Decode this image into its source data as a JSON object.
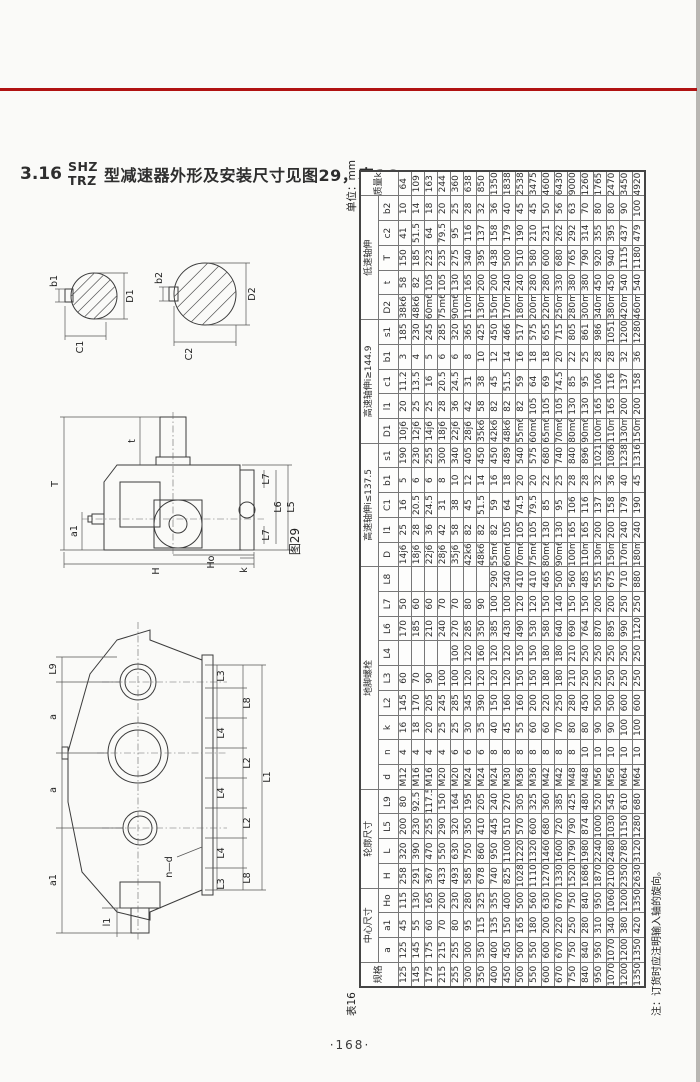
{
  "colors": {
    "rule_red": "#b01212"
  },
  "title": {
    "section": "3.16",
    "model_top": "SHZ",
    "model_bottom": "TRZ",
    "text": "型减速器外形及安装尺寸见图29，表16."
  },
  "page_number": "·168·",
  "figure29": {
    "caption": "图29",
    "shaft_small": {
      "b1": "b1",
      "C1": "C1",
      "D1": "D1"
    },
    "shaft_large": {
      "b2": "b2",
      "C2": "C2",
      "D2": "D2"
    },
    "side_view": {
      "T": "T",
      "t": "t",
      "a1": "a1",
      "H": "H",
      "Ho": "Ho",
      "L5": "L5",
      "L6": "L6",
      "L7_top": "L7",
      "L7_bottom": "L7",
      "k": "k"
    },
    "top_view": {
      "L9": "L9",
      "a_upper": "a",
      "a_lower": "a",
      "a1": "a1",
      "l1": "l1",
      "n_d": "n—d",
      "L1": "L1",
      "L3_top": "L3",
      "L8_top": "L8",
      "L4_top": "L4",
      "L2_upper": "L2",
      "L4_mid": "L4",
      "L2_lower": "L2",
      "L4_bot": "L4",
      "L8_bot": "L8",
      "L3_bot": "L3"
    }
  },
  "table16": {
    "caption": "表16",
    "unit": "单位：mm",
    "note": "注：订货时应注明输入轴的旋向。",
    "col_groups": [
      {
        "label": "规格"
      },
      {
        "label": "中心尺寸",
        "cols": [
          "a",
          "a1",
          "Ho"
        ]
      },
      {
        "label": "轮廓尺寸",
        "cols": [
          "H",
          "L",
          "L5",
          "L9"
        ]
      },
      {
        "label": "地脚螺栓",
        "cols": [
          "d",
          "n",
          "k",
          "L2",
          "L3",
          "L4",
          "L6",
          "L7",
          "L8"
        ]
      },
      {
        "label": "高速轴伸i≤137.5",
        "cols": [
          "D",
          "l1",
          "C1",
          "b1",
          "s1"
        ]
      },
      {
        "label": "高速轴伸i≥144.9",
        "cols": [
          "D1",
          "l1",
          "c1",
          "b1",
          "s1"
        ]
      },
      {
        "label": "低速轴伸",
        "cols": [
          "D2",
          "t",
          "T",
          "c2",
          "b2"
        ]
      },
      {
        "label": "质量kg"
      }
    ],
    "rows": [
      [
        125,
        125,
        45,
        115,
        258,
        320,
        200,
        80,
        "M12",
        4,
        16,
        145,
        60,
        "",
        170,
        50,
        "",
        "14j6",
        25,
        16,
        5,
        190,
        "10j6",
        20,
        11.2,
        3,
        185,
        "38k6",
        58,
        150,
        41,
        10,
        64
      ],
      [
        145,
        145,
        55,
        130,
        291,
        390,
        230,
        92.5,
        "M16",
        4,
        18,
        170,
        70,
        "",
        185,
        60,
        "",
        "18j6",
        28,
        20.5,
        6,
        230,
        "12j6",
        25,
        13.5,
        4,
        230,
        "48k6",
        82,
        185,
        51.5,
        14,
        109
      ],
      [
        175,
        175,
        60,
        165,
        367,
        470,
        255,
        117.5,
        "M16",
        4,
        20,
        205,
        90,
        "",
        210,
        60,
        "",
        "22j6",
        36,
        24.5,
        6,
        255,
        "14j6",
        25,
        16,
        5,
        245,
        "60m6",
        105,
        223,
        64,
        18,
        163
      ],
      [
        215,
        215,
        70,
        200,
        433,
        550,
        290,
        150,
        "M20",
        4,
        25,
        245,
        100,
        "",
        240,
        70,
        "",
        "28j6",
        42,
        31,
        8,
        300,
        "18j6",
        28,
        20.5,
        6,
        285,
        "75m6",
        105,
        235,
        79.5,
        20,
        244
      ],
      [
        255,
        255,
        80,
        230,
        493,
        630,
        320,
        164,
        "M20",
        6,
        25,
        285,
        100,
        100,
        270,
        70,
        "",
        "35j6",
        58,
        38,
        10,
        340,
        "22j6",
        36,
        24.5,
        6,
        320,
        "90m6",
        130,
        275,
        95,
        25,
        360
      ],
      [
        300,
        300,
        95,
        280,
        585,
        750,
        350,
        195,
        "M24",
        6,
        30,
        345,
        120,
        120,
        285,
        80,
        "",
        "42k6",
        82,
        45,
        12,
        405,
        "28j6",
        42,
        31,
        8,
        365,
        "110m6",
        165,
        340,
        116,
        28,
        638
      ],
      [
        350,
        350,
        115,
        325,
        678,
        860,
        410,
        205,
        "M24",
        6,
        35,
        390,
        120,
        160,
        350,
        90,
        "",
        "48k6",
        82,
        51.5,
        14,
        450,
        "35k6",
        58,
        38,
        10,
        425,
        "130m6",
        200,
        395,
        137,
        32,
        850
      ],
      [
        400,
        400,
        135,
        355,
        740,
        950,
        445,
        240,
        "M24",
        8,
        40,
        150,
        120,
        120,
        385,
        100,
        290,
        "55m6",
        82,
        59,
        16,
        450,
        "42k6",
        82,
        45,
        12,
        450,
        "150m6",
        200,
        438,
        158,
        36,
        1350
      ],
      [
        450,
        450,
        150,
        400,
        825,
        1100,
        510,
        270,
        "M30",
        8,
        45,
        160,
        120,
        120,
        430,
        100,
        340,
        "60m6",
        105,
        64,
        18,
        489,
        "48k6",
        82,
        51.5,
        14,
        466,
        "170m6",
        240,
        500,
        179,
        40,
        1838
      ],
      [
        500,
        500,
        165,
        500,
        1028,
        1220,
        570,
        305,
        "M36",
        8,
        55,
        160,
        150,
        150,
        490,
        120,
        410,
        "70m6",
        105,
        74.5,
        20,
        540,
        "55m6",
        82,
        59,
        16,
        517,
        "180m6",
        240,
        510,
        190,
        45,
        2538
      ],
      [
        550,
        550,
        180,
        560,
        1110,
        1320,
        600,
        325,
        "M36",
        8,
        60,
        200,
        150,
        150,
        530,
        120,
        410,
        "75m6",
        105,
        79.5,
        20,
        575,
        "60m6",
        105,
        64,
        18,
        575,
        "200m6",
        280,
        580,
        210,
        45,
        3475
      ],
      [
        600,
        600,
        200,
        630,
        1270,
        1460,
        680,
        360,
        "M42",
        8,
        60,
        220,
        180,
        180,
        580,
        150,
        465,
        "80m6",
        130,
        85,
        22,
        680,
        "65m6",
        105,
        69,
        18,
        655,
        "220m6",
        280,
        600,
        231,
        50,
        4600
      ],
      [
        670,
        670,
        220,
        670,
        1330,
        1600,
        720,
        385,
        "M42",
        8,
        70,
        250,
        180,
        180,
        640,
        140,
        500,
        "90m6",
        130,
        95,
        25,
        740,
        "70m6",
        105,
        74.5,
        20,
        715,
        "250m6",
        330,
        680,
        262,
        56,
        6430
      ],
      [
        750,
        750,
        250,
        750,
        1520,
        1790,
        790,
        425,
        "M48",
        8,
        80,
        280,
        210,
        210,
        690,
        150,
        560,
        "100m6",
        165,
        106,
        28,
        840,
        "80m6",
        130,
        85,
        22,
        805,
        "280m6",
        380,
        765,
        292,
        63,
        9000
      ],
      [
        840,
        840,
        280,
        840,
        1686,
        1980,
        874,
        480,
        "M48",
        10,
        80,
        450,
        250,
        250,
        764,
        150,
        485,
        "110m6",
        165,
        116,
        28,
        896,
        "90m6",
        130,
        95,
        25,
        861,
        "300m6",
        380,
        790,
        314,
        70,
        12600
      ],
      [
        950,
        950,
        310,
        950,
        1870,
        2240,
        1000,
        520,
        "M56",
        10,
        90,
        500,
        250,
        250,
        870,
        200,
        555,
        "130m6",
        200,
        137,
        32,
        1021,
        "100m6",
        165,
        106,
        28,
        986,
        "340m6",
        450,
        920,
        355,
        80,
        17650
      ],
      [
        1070,
        1070,
        340,
        1060,
        2100,
        2480,
        1030,
        545,
        "M56",
        10,
        90,
        500,
        250,
        250,
        895,
        200,
        675,
        "150m6",
        200,
        158,
        36,
        1086,
        "110m6",
        165,
        116,
        28,
        1051,
        "380m6",
        450,
        940,
        395,
        80,
        24700
      ],
      [
        1200,
        1200,
        380,
        1200,
        2350,
        2780,
        1150,
        610,
        "M64",
        10,
        100,
        600,
        250,
        250,
        990,
        250,
        710,
        "170m6",
        240,
        179,
        40,
        1238,
        "130m6",
        200,
        137,
        32,
        1200,
        "420m6",
        540,
        1115,
        437,
        90,
        34500
      ],
      [
        1350,
        1350,
        420,
        1350,
        2630,
        3120,
        1280,
        680,
        "M64",
        10,
        100,
        600,
        250,
        250,
        1120,
        250,
        880,
        "180m6",
        240,
        190,
        45,
        1316,
        "150m6",
        200,
        158,
        36,
        1280,
        "460m6",
        540,
        1180,
        479,
        100,
        49200
      ]
    ]
  }
}
